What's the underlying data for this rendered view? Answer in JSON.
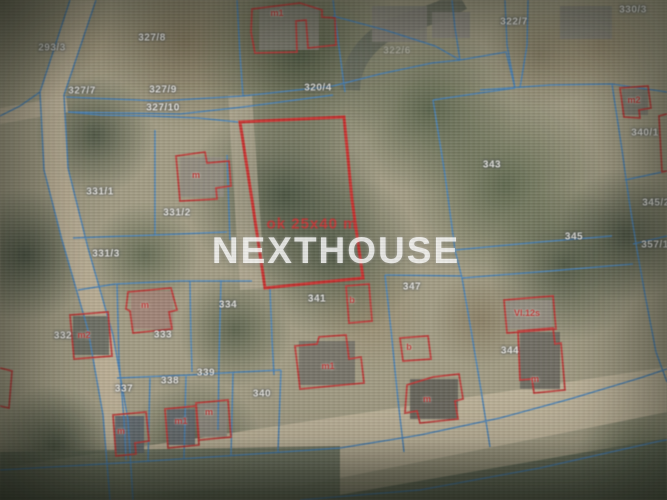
{
  "map": {
    "watermark": "NEXTHOUSE",
    "plot": {
      "dimension_label": "ok 25x40 m"
    },
    "colors": {
      "parcel_line": "#2f7bc4",
      "building_outline": "#d02020",
      "highlight_outline": "#e01515",
      "parcel_label_text": "#f4f2ee",
      "building_label_text": "#d02020",
      "watermark_text": "#ffffff"
    },
    "parcel_labels": [
      {
        "text": "293/3",
        "x": 52,
        "y": 48
      },
      {
        "text": "327/8",
        "x": 152,
        "y": 38
      },
      {
        "text": "327/7",
        "x": 82,
        "y": 91
      },
      {
        "text": "327/9",
        "x": 163,
        "y": 90
      },
      {
        "text": "327/10",
        "x": 163,
        "y": 108
      },
      {
        "text": "320/4",
        "x": 318,
        "y": 88
      },
      {
        "text": "322/6",
        "x": 397,
        "y": 51,
        "faint": true
      },
      {
        "text": "322/7",
        "x": 514,
        "y": 22
      },
      {
        "text": "330/3",
        "x": 633,
        "y": 10
      },
      {
        "text": "340/1",
        "x": 645,
        "y": 133
      },
      {
        "text": "343",
        "x": 492,
        "y": 165
      },
      {
        "text": "345",
        "x": 574,
        "y": 237
      },
      {
        "text": "345/2",
        "x": 656,
        "y": 203
      },
      {
        "text": "357/1",
        "x": 655,
        "y": 245
      },
      {
        "text": "331/1",
        "x": 100,
        "y": 192
      },
      {
        "text": "331/2",
        "x": 177,
        "y": 213
      },
      {
        "text": "331/3",
        "x": 106,
        "y": 254
      },
      {
        "text": "334",
        "x": 228,
        "y": 305
      },
      {
        "text": "341",
        "x": 317,
        "y": 299
      },
      {
        "text": "347",
        "x": 412,
        "y": 287
      },
      {
        "text": "332",
        "x": 63,
        "y": 336
      },
      {
        "text": "333",
        "x": 163,
        "y": 335
      },
      {
        "text": "344",
        "x": 510,
        "y": 351
      },
      {
        "text": "337",
        "x": 124,
        "y": 389
      },
      {
        "text": "338",
        "x": 170,
        "y": 381
      },
      {
        "text": "339",
        "x": 206,
        "y": 373
      },
      {
        "text": "340",
        "x": 262,
        "y": 394
      }
    ],
    "building_labels": [
      {
        "text": "m1",
        "x": 277,
        "y": 13
      },
      {
        "text": "m2",
        "x": 634,
        "y": 100
      },
      {
        "text": "m",
        "x": 196,
        "y": 175
      },
      {
        "text": "m",
        "x": 145,
        "y": 305
      },
      {
        "text": "m2",
        "x": 84,
        "y": 335
      },
      {
        "text": "b",
        "x": 352,
        "y": 300
      },
      {
        "text": "m1",
        "x": 328,
        "y": 366
      },
      {
        "text": "b",
        "x": 409,
        "y": 347
      },
      {
        "text": "m",
        "x": 427,
        "y": 399
      },
      {
        "text": "VI.12s",
        "x": 527,
        "y": 313
      },
      {
        "text": "m",
        "x": 535,
        "y": 379
      },
      {
        "text": "m",
        "x": 121,
        "y": 431
      },
      {
        "text": "m1",
        "x": 181,
        "y": 421
      },
      {
        "text": "m",
        "x": 209,
        "y": 412
      }
    ]
  }
}
